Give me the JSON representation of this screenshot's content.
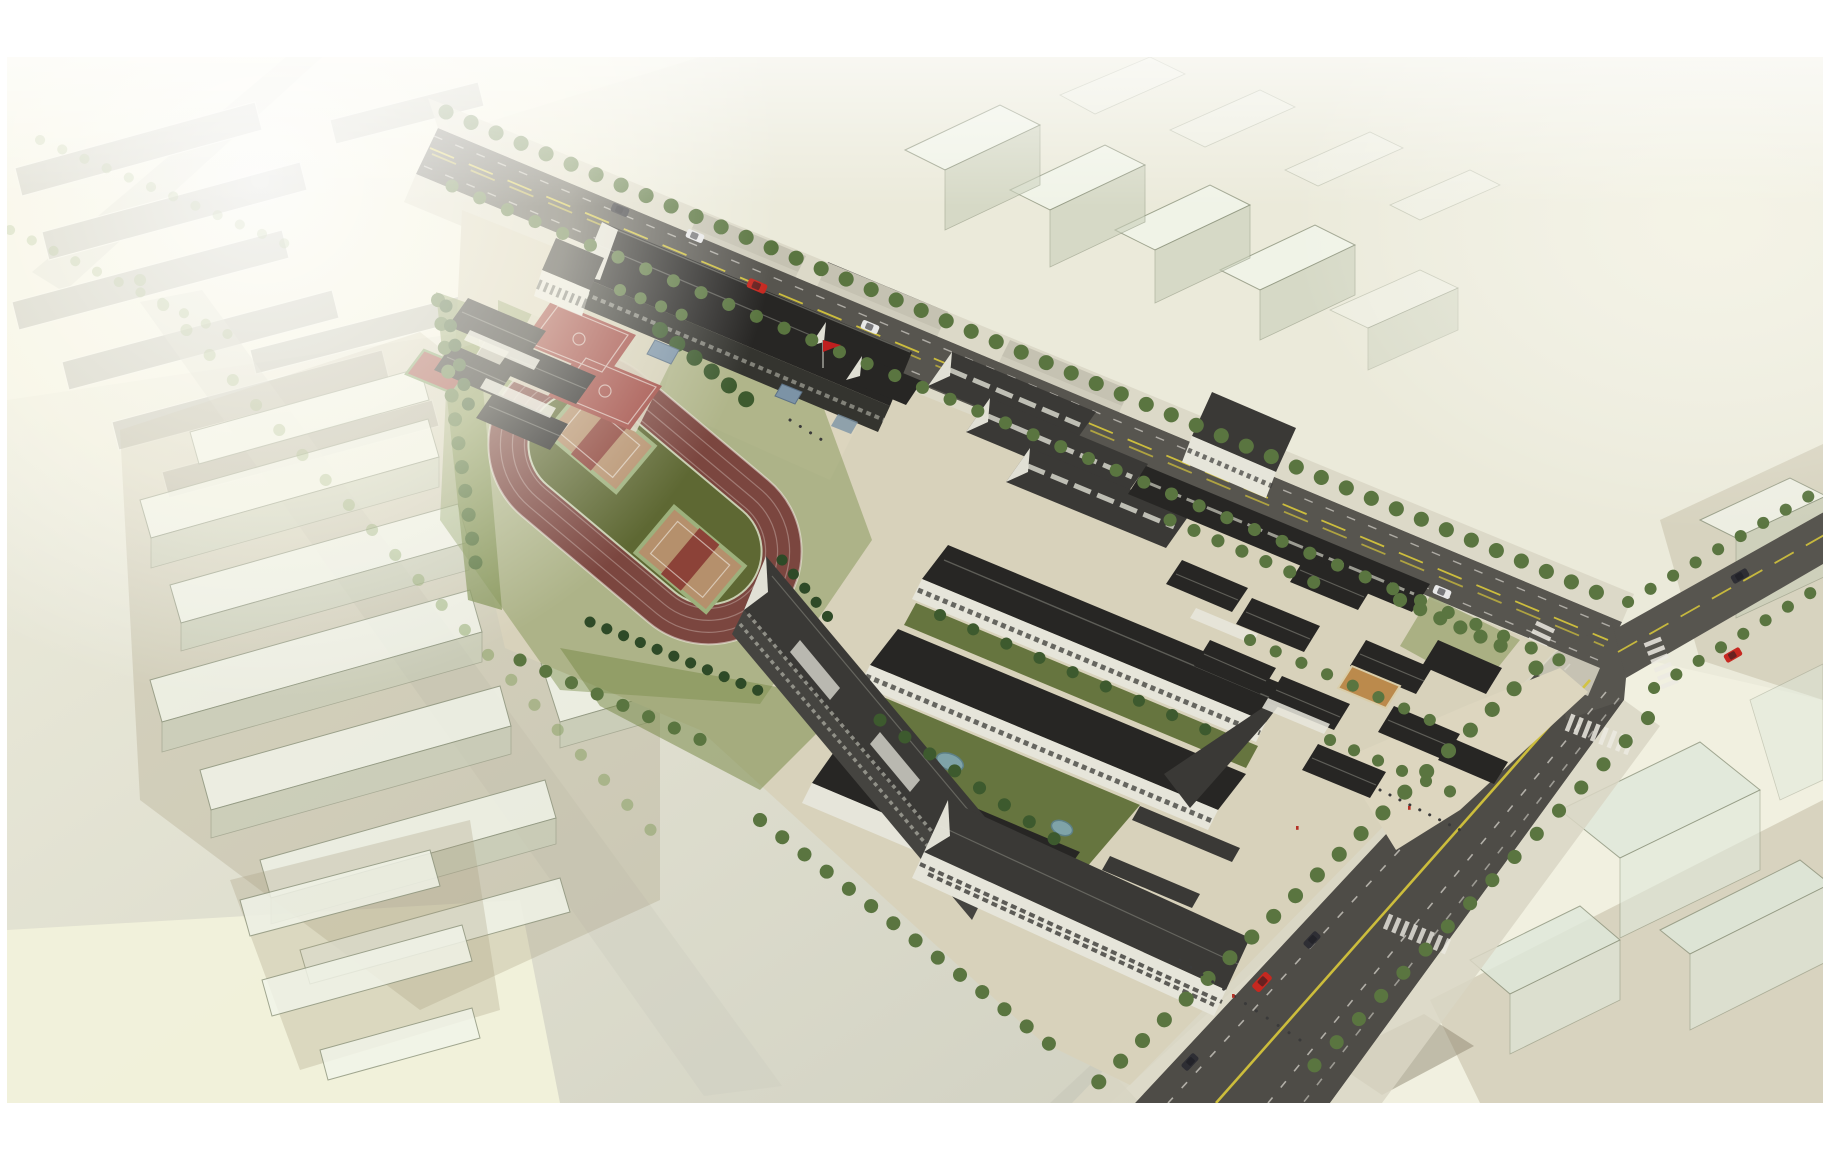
{
  "image": {
    "type": "architectural aerial rendering",
    "subject": "bird's-eye masterplan view of a school campus with running track, courts, courtyard school buildings, tree-lined roads and translucent context massing"
  },
  "palette": {
    "margin_white": "#ffffff",
    "ground_base": "#f1f0e0",
    "ground_top_right": "#ebeada",
    "ground_sage": "#dadaca",
    "ground_pale_yellow": "#f3f3dc",
    "ground_near_road": "#c6c6b8",
    "plaza_beige": "#d8d2bb",
    "plaza_light": "#ddd6bf",
    "asphalt": "#57554f",
    "asphalt_dark": "#4e4c47",
    "lane_yellow": "#d3c33c",
    "lane_white": "#dddad2",
    "zebra_white": "#eceae2",
    "sidewalk": "#d9d6c4",
    "lawn": "#7b8d4c",
    "lawn_dark": "#66753f",
    "track_surface": "#7b463f",
    "track_line": "#e5d8d2",
    "infield_green": "#5d6a33",
    "infield_court_tan": "#b5906c",
    "infield_court_stripe": "#8c4238",
    "court_red": "#a04a42",
    "court_small_red": "#9c4a42",
    "court_orange": "#bb8a4c",
    "roof_dark": "#272624",
    "roof_mid": "#3a3936",
    "roof_gray": "#55544e",
    "facade_white": "#e6e5da",
    "facade_dark": "#454440",
    "facade_darker": "#34342f",
    "window_dark": "#3b3b37",
    "window_light": "#d0d0c4",
    "gray_walls": "#96968c",
    "tree_mid": "#5a7540",
    "tree_dark": "#3d5a2e",
    "tree_light": "#7d9a55",
    "conifer": "#2e4a27",
    "ghost_face": "#f2f5ea",
    "ghost_side": "#c9cfba",
    "ghost_glass": "#dfe8da",
    "tan_ground": "#a89f82",
    "olive_ground": "#8f8871",
    "faded_roof": "#8b8b83",
    "faded_road": "#cfcfc2",
    "water": "#7fa3a8",
    "canopy_blue": "#7c93a6",
    "car_red": "#c62820",
    "car_dark": "#2e2e34",
    "car_white": "#e8e8e8",
    "flag_red": "#c01f1f",
    "people_dark": "#3a3a3a",
    "people_red": "#b53126",
    "stand_gray": "#b5b2a4"
  },
  "scene": {
    "features": [
      "white page margin",
      "pale site ground",
      "faded old-town blocks top-left",
      "translucent ghost massing west",
      "ghost massing north-east",
      "ghost glass blocks south-east",
      "main avenue with yellow centerline",
      "north-east branch road",
      "south-east boulevard",
      "intersection with zebra crossings",
      "street tree rows",
      "cars",
      "school campus paving",
      "running track with olive infield and two tan courts",
      "two red basketball courts",
      "small red court",
      "grandstand",
      "north classroom building",
      "west entrance building",
      "north-west courtyard houses",
      "three gabled halls",
      "central courtyard complex with gardens and ponds",
      "south-west classroom block",
      "south classroom building",
      "east heritage courtyard cluster",
      "orange courtyard",
      "flagpole with red flag",
      "blue canopies",
      "tiny pedestrians"
    ]
  }
}
